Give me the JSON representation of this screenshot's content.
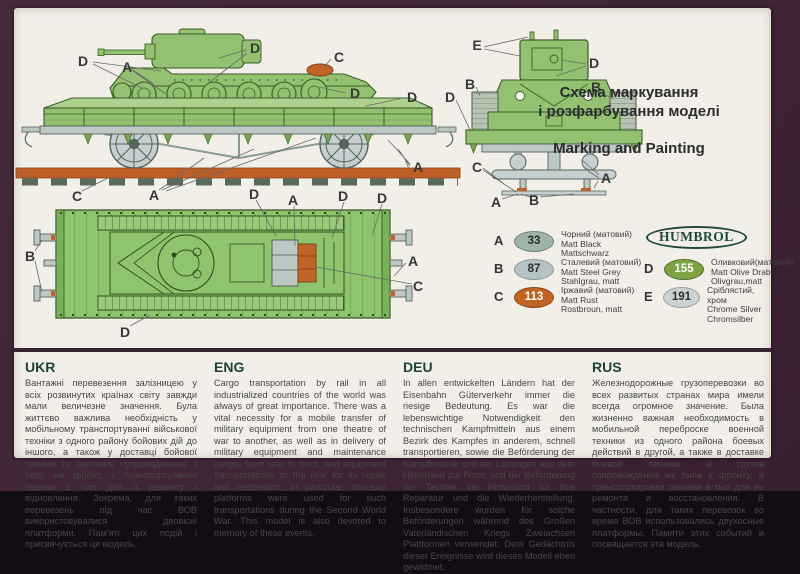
{
  "title": {
    "uk_line1": "Схема маркування",
    "uk_line2": "і розфарбування моделі",
    "en": "Marking and Painting"
  },
  "humbrol_logo": "HUMBROL",
  "paint_chart": {
    "left": [
      {
        "letter": "A",
        "code": "33",
        "swatch": "#9fb3a6",
        "border": "#6f8578",
        "text_color": "#2e2e2e",
        "names": [
          "Чорний (матовий)",
          "Matt Black",
          "Mattschwarz"
        ]
      },
      {
        "letter": "B",
        "code": "87",
        "swatch": "#b5c3c4",
        "border": "#86989b",
        "text_color": "#2e2e2e",
        "names": [
          "Сталевий (матовий)",
          "Matt Steel Grey",
          "Stahlgrau, matt"
        ]
      },
      {
        "letter": "C",
        "code": "113",
        "swatch": "#c06325",
        "border": "#8a4413",
        "text_color": "#ffffff",
        "names": [
          "Іржавий (матовий)",
          "Matt Rust",
          "Rostbroun, matt"
        ]
      }
    ],
    "right": [
      {
        "letter": "D",
        "code": "155",
        "swatch": "#7da342",
        "border": "#4f6e27",
        "text_color": "#ffffff",
        "names": [
          "Оливковий(матовий)",
          "Matt Olive Drab",
          "Olivgrau,matt"
        ]
      },
      {
        "letter": "E",
        "code": "191",
        "swatch": "#ccd2d0",
        "border": "#979f9e",
        "text_color": "#2e2e2e",
        "names": [
          "Сріблястий, хром",
          "Chrome Silver",
          "Chromsilber"
        ]
      }
    ]
  },
  "sections": [
    {
      "lang": "UKR",
      "text": "Вантажні перевезення залізницею у всіх розвинутих країнах світу завжди мали величезне значення. Була життєво важлива необхідність у мобільному транспортуванні військової техніки з одного району бойових дій до іншого, а також у доставці бойової техніки та вантажів супроводження з тилу на фронт, і транспортування техніки в тил для її ремонту і відновлення. Зокрема, для таких перевезень під час ВОВ використовувалися двовісні платформи. Пам'яті цих подій і присвячується ця модель."
    },
    {
      "lang": "ENG",
      "text": "Cargo transportation by rail in all industrialized countries of the world was always of great importance. There was a vital necessity for a mobile transfer of military equipment from one theatre of war to another, as well as in delivery of military equipment and maintenance cargos from rear to front, and equipment transportations to the rear for its repair and restoration. In particular, two-axis platforms were used for such transportations during the Second World War. This model is also devoted to memory of these events."
    },
    {
      "lang": "DEU",
      "text": "In allen entwickelten Ländern hat der Eisenbahn Güterverkehr immer die riesige Bedeutung. Es war die lebenswichtige Notwendigkeit den technischen Kampfmitteln aus einem Bezirk des Kampfes in anderem, schnell transportieren, sowie die Beförderung der Kampftechnik und der Ladungen aus dem Hinterland zur Front, und der Beförderung der Technik ins Hinterland für ihre Reparatur und die Wiederherstellung. Insbesondere wurden für solche Beförderungen während des Großen Vaterländischen Kriegs Zweiachsen Plattformen verwendet. Dem Gedächtnis dieser Ereignisse wird dieses Modell eben gewidmet."
    },
    {
      "lang": "RUS",
      "text": "Железнодорожные грузоперевозки во всех развитых странах мира имели всегда огромное значение. Была жизненно важная необходимость в мобильной переброске военной техники из одного района боевых действий в другой, а также в доставке боевой техники и грузов сопровождения из тыла к фронту, и транспортировки техники в тыл для ее ремонта и восстановления. В частности, для таких перевозок во время ВОВ использовались двухосные платформы. Памяти этих событий и посвящается эта модель."
    }
  ],
  "diagram_labels": [
    {
      "t": "D",
      "x": 69,
      "y": 53
    },
    {
      "t": "A",
      "x": 113,
      "y": 59
    },
    {
      "t": "D",
      "x": 241,
      "y": 40
    },
    {
      "t": "C",
      "x": 325,
      "y": 49
    },
    {
      "t": "D",
      "x": 341,
      "y": 85
    },
    {
      "t": "D",
      "x": 398,
      "y": 89
    },
    {
      "t": "A",
      "x": 404,
      "y": 159
    },
    {
      "t": "C",
      "x": 63,
      "y": 188
    },
    {
      "t": "A",
      "x": 140,
      "y": 187
    },
    {
      "t": "D",
      "x": 240,
      "y": 186
    },
    {
      "t": "A",
      "x": 279,
      "y": 192
    },
    {
      "t": "D",
      "x": 329,
      "y": 188
    },
    {
      "t": "D",
      "x": 368,
      "y": 190
    },
    {
      "t": "B",
      "x": 16,
      "y": 248
    },
    {
      "t": "D",
      "x": 111,
      "y": 324
    },
    {
      "t": "A",
      "x": 399,
      "y": 253
    },
    {
      "t": "C",
      "x": 404,
      "y": 278
    },
    {
      "t": "E",
      "x": 463,
      "y": 37
    },
    {
      "t": "D",
      "x": 580,
      "y": 55
    },
    {
      "t": "B",
      "x": 456,
      "y": 76
    },
    {
      "t": "B",
      "x": 582,
      "y": 79
    },
    {
      "t": "D",
      "x": 436,
      "y": 89
    },
    {
      "t": "C",
      "x": 463,
      "y": 159
    },
    {
      "t": "A",
      "x": 592,
      "y": 170
    },
    {
      "t": "A",
      "x": 482,
      "y": 194
    },
    {
      "t": "B",
      "x": 520,
      "y": 192
    }
  ],
  "colors": {
    "sheet": "#f1efe8",
    "frame_purple": "#402438",
    "tank_green": "#93c171",
    "deck_green": "#8ec46e",
    "chassis_grey": "#bcc8c4",
    "rail_rust": "#bd5f26",
    "header_green": "#1c4434"
  }
}
